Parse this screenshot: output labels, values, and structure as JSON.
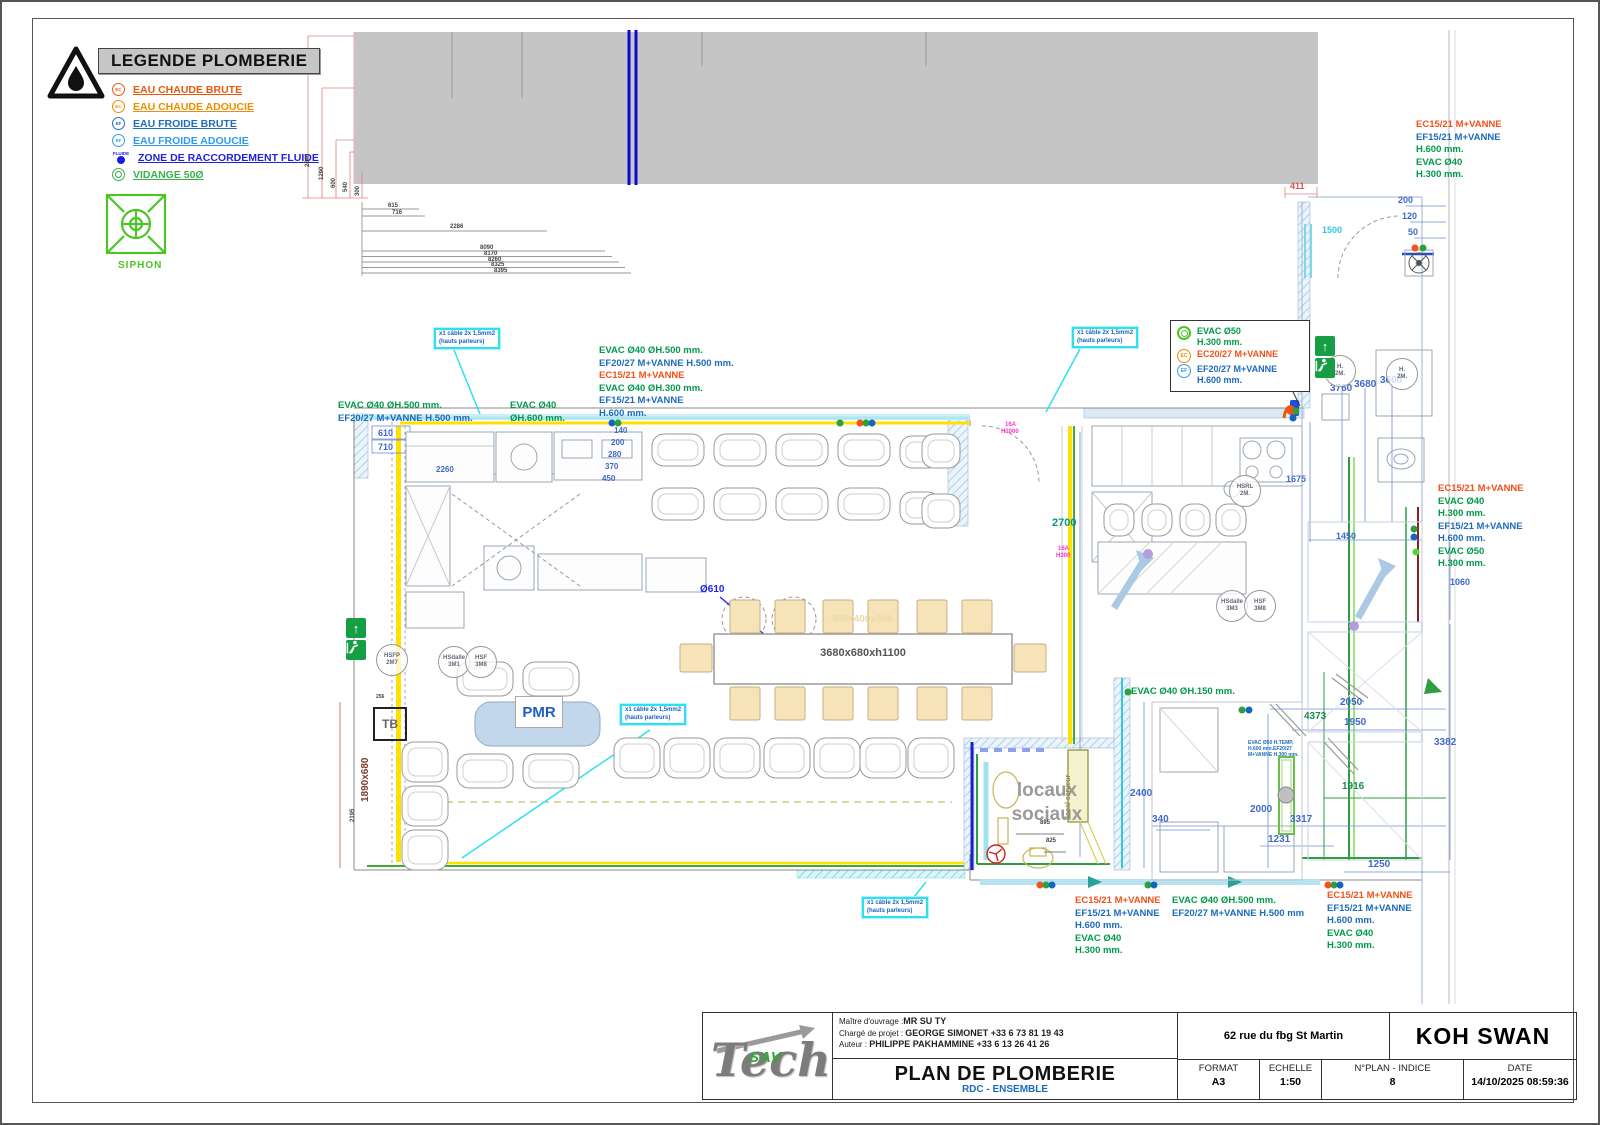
{
  "colors": {
    "hot_water": "#e8590c",
    "hot_softened": "#f08c00",
    "cold_water": "#1b6ec2",
    "cold_softened": "#2f9bf0",
    "fluid": "#2222dd",
    "drain": "#37b24d",
    "dim_blue": "#4169c9",
    "callout_cyan": "#2de0f0",
    "pink": "#ff2fd2",
    "wall_yellow": "#ffe000"
  },
  "legend": {
    "title": "LEGENDE PLOMBERIE",
    "items": [
      {
        "label": "EAU CHAUDE BRUTE",
        "color": "#e8590c",
        "icon": "ec",
        "icon_text": "EC"
      },
      {
        "label": "EAU CHAUDE ADOUCIE",
        "color": "#f08c00",
        "icon": "ec",
        "icon_text": "EC"
      },
      {
        "label": "EAU FROIDE BRUTE",
        "color": "#1b6ec2",
        "icon": "ef",
        "icon_text": "EF"
      },
      {
        "label": "EAU FROIDE ADOUCIE",
        "color": "#2f9bf0",
        "icon": "ef",
        "icon_text": "EF"
      },
      {
        "label": "ZONE DE RACCORDEMENT FLUIDE",
        "color": "#2222dd",
        "icon": "fluide",
        "icon_text": "FLUIDE"
      },
      {
        "label": "VIDANGE 50Ø",
        "color": "#37b24d",
        "icon": "vidange",
        "icon_text": ""
      }
    ],
    "siphon_label": "SIPHON"
  },
  "plan": {
    "cable_note_line1": "x1 câble 2x 1,5mm2",
    "cable_note_line2": "(hauts parleurs)",
    "cable_notes": [
      {
        "x": 432,
        "y": 326
      },
      {
        "x": 1070,
        "y": 325
      },
      {
        "x": 618,
        "y": 702
      },
      {
        "x": 860,
        "y": 895
      }
    ],
    "annotations": [
      {
        "x": 336,
        "y": 398,
        "lines": [
          {
            "t": "EVAC Ø40  ØH.500 mm.",
            "c": "g"
          },
          {
            "t": "EF20/27 M+VANNE H.500 mm.",
            "c": "b"
          }
        ]
      },
      {
        "x": 508,
        "y": 398,
        "lines": [
          {
            "t": "EVAC Ø40",
            "c": "g"
          },
          {
            "t": "ØH.600 mm.",
            "c": "g"
          }
        ]
      },
      {
        "x": 597,
        "y": 343,
        "lines": [
          {
            "t": "EVAC Ø40  ØH.500 mm.",
            "c": "g"
          },
          {
            "t": "EF20/27 M+VANNE H.500 mm.",
            "c": "b"
          },
          {
            "t": "EC15/21 M+VANNE",
            "c": "o"
          },
          {
            "t": "EVAC Ø40  ØH.300 mm.",
            "c": "g"
          },
          {
            "t": "EF15/21 M+VANNE",
            "c": "b"
          },
          {
            "t": "H.600 mm.",
            "c": "b"
          }
        ]
      },
      {
        "x": 1414,
        "y": 117,
        "lines": [
          {
            "t": "EC15/21 M+VANNE",
            "c": "o"
          },
          {
            "t": "EF15/21 M+VANNE",
            "c": "b"
          },
          {
            "t": "H.600 mm.",
            "c": "g"
          },
          {
            "t": "EVAC Ø40",
            "c": "g"
          },
          {
            "t": "H.300 mm.",
            "c": "g"
          }
        ]
      },
      {
        "x": 1436,
        "y": 481,
        "lines": [
          {
            "t": "EC15/21 M+VANNE",
            "c": "o"
          },
          {
            "t": "EVAC Ø40",
            "c": "g"
          },
          {
            "t": "H.300 mm.",
            "c": "g"
          },
          {
            "t": "EF15/21 M+VANNE",
            "c": "b"
          },
          {
            "t": "H.600 mm.",
            "c": "b"
          },
          {
            "t": "EVAC Ø50",
            "c": "g"
          },
          {
            "t": "H.300 mm.",
            "c": "g"
          }
        ]
      },
      {
        "x": 1129,
        "y": 684,
        "lines": [
          {
            "t": "EVAC Ø40  ØH.150 mm.",
            "c": "g"
          }
        ]
      },
      {
        "x": 1073,
        "y": 893,
        "lines": [
          {
            "t": "EC15/21 M+VANNE",
            "c": "o"
          },
          {
            "t": "EF15/21 M+VANNE",
            "c": "b"
          },
          {
            "t": "H.600 mm.",
            "c": "b"
          },
          {
            "t": "EVAC Ø40",
            "c": "g"
          },
          {
            "t": "H.300 mm.",
            "c": "g"
          }
        ]
      },
      {
        "x": 1170,
        "y": 893,
        "lines": [
          {
            "t": "EVAC Ø40  ØH.500 mm.",
            "c": "g"
          },
          {
            "t": "EF20/27 M+VANNE H.500 mm",
            "c": "b"
          }
        ]
      },
      {
        "x": 1325,
        "y": 888,
        "lines": [
          {
            "t": "EC15/21 M+VANNE",
            "c": "o"
          },
          {
            "t": "EF15/21 M+VANNE",
            "c": "b"
          },
          {
            "t": "H.600 mm.",
            "c": "b"
          },
          {
            "t": "EVAC Ø40",
            "c": "g"
          },
          {
            "t": "H.300 mm.",
            "c": "g"
          }
        ]
      },
      {
        "x": 1246,
        "y": 738,
        "sz": "tiny",
        "lines": [
          {
            "t": "EVAC Ø50 H.TEMP,",
            "c": "b"
          },
          {
            "t": "H.600 mm.EF20/27",
            "c": "b"
          },
          {
            "t": "M+VANNE H.300 mm.",
            "c": "b"
          }
        ]
      }
    ],
    "boxed_callout": {
      "rows": [
        {
          "icon": "vid",
          "lines": [
            {
              "t": "EVAC Ø50",
              "c": "g"
            },
            {
              "t": "H.300 mm.",
              "c": "g"
            }
          ]
        },
        {
          "icon": "ec",
          "lines": [
            {
              "t": "EC20/27 M+VANNE",
              "c": "o"
            }
          ]
        },
        {
          "icon": "ef",
          "lines": [
            {
              "t": "EF20/27 M+VANNE",
              "c": "b"
            },
            {
              "t": "H.600 mm.",
              "c": "b"
            }
          ]
        }
      ]
    },
    "dims": [
      {
        "t": "615",
        "x": 386,
        "y": 201,
        "c": "k",
        "s": 6
      },
      {
        "t": "716",
        "x": 390,
        "y": 208,
        "c": "k",
        "s": 6
      },
      {
        "t": "2286",
        "x": 448,
        "y": 222,
        "c": "k",
        "s": 6
      },
      {
        "t": "8090",
        "x": 478,
        "y": 243,
        "c": "k",
        "s": 6
      },
      {
        "t": "8170",
        "x": 482,
        "y": 249,
        "c": "k",
        "s": 6
      },
      {
        "t": "8260",
        "x": 486,
        "y": 255,
        "c": "k",
        "s": 6
      },
      {
        "t": "8325",
        "x": 489,
        "y": 260,
        "c": "k",
        "s": 6
      },
      {
        "t": "8395",
        "x": 492,
        "y": 266,
        "c": "k",
        "s": 6
      },
      {
        "t": "2040",
        "x": 303,
        "y": 165,
        "c": "k",
        "s": 6,
        "r": -90
      },
      {
        "t": "1290",
        "x": 317,
        "y": 178,
        "c": "k",
        "s": 6,
        "r": -90
      },
      {
        "t": "600",
        "x": 329,
        "y": 186,
        "c": "k",
        "s": 6,
        "r": -90
      },
      {
        "t": "540",
        "x": 341,
        "y": 190,
        "c": "k",
        "s": 6,
        "r": -90
      },
      {
        "t": "300",
        "x": 353,
        "y": 194,
        "c": "k",
        "s": 6,
        "r": -90
      },
      {
        "t": "411",
        "x": 1288,
        "y": 179,
        "c": "r",
        "s": 9
      },
      {
        "t": "1500",
        "x": 1320,
        "y": 223,
        "c": "cy",
        "s": 9
      },
      {
        "t": "200",
        "x": 1396,
        "y": 193,
        "c": "d",
        "s": 9
      },
      {
        "t": "120",
        "x": 1400,
        "y": 209,
        "c": "d",
        "s": 9
      },
      {
        "t": "50",
        "x": 1406,
        "y": 225,
        "c": "d",
        "s": 9
      },
      {
        "t": "610",
        "x": 376,
        "y": 426,
        "c": "d",
        "s": 9
      },
      {
        "t": "710",
        "x": 376,
        "y": 440,
        "c": "d",
        "s": 9
      },
      {
        "t": "2260",
        "x": 434,
        "y": 463,
        "c": "d",
        "s": 8
      },
      {
        "t": "140",
        "x": 612,
        "y": 424,
        "c": "d",
        "s": 8
      },
      {
        "t": "200",
        "x": 609,
        "y": 436,
        "c": "d",
        "s": 8
      },
      {
        "t": "280",
        "x": 606,
        "y": 448,
        "c": "d",
        "s": 8
      },
      {
        "t": "370",
        "x": 603,
        "y": 460,
        "c": "d",
        "s": 8
      },
      {
        "t": "450",
        "x": 600,
        "y": 472,
        "c": "d",
        "s": 8
      },
      {
        "t": "1675",
        "x": 1284,
        "y": 472,
        "c": "d",
        "s": 9
      },
      {
        "t": "2700",
        "x": 1050,
        "y": 515,
        "c": "t",
        "s": 11
      },
      {
        "t": "3760",
        "x": 1328,
        "y": 381,
        "c": "d",
        "s": 10
      },
      {
        "t": "3680",
        "x": 1352,
        "y": 377,
        "c": "d",
        "s": 10
      },
      {
        "t": "3600",
        "x": 1378,
        "y": 373,
        "c": "d",
        "s": 10
      },
      {
        "t": "1450",
        "x": 1334,
        "y": 529,
        "c": "d",
        "s": 9
      },
      {
        "t": "1060",
        "x": 1448,
        "y": 575,
        "c": "d",
        "s": 9
      },
      {
        "t": "2050",
        "x": 1338,
        "y": 695,
        "c": "d",
        "s": 10
      },
      {
        "t": "4373",
        "x": 1302,
        "y": 709,
        "c": "gn",
        "s": 10
      },
      {
        "t": "1950",
        "x": 1342,
        "y": 715,
        "c": "d",
        "s": 10
      },
      {
        "t": "1916",
        "x": 1340,
        "y": 779,
        "c": "gn",
        "s": 10
      },
      {
        "t": "2000",
        "x": 1248,
        "y": 802,
        "c": "d",
        "s": 10
      },
      {
        "t": "3317",
        "x": 1288,
        "y": 812,
        "c": "d",
        "s": 10
      },
      {
        "t": "1231",
        "x": 1266,
        "y": 832,
        "c": "d",
        "s": 10
      },
      {
        "t": "3382",
        "x": 1432,
        "y": 735,
        "c": "d",
        "s": 10
      },
      {
        "t": "2400",
        "x": 1128,
        "y": 786,
        "c": "d",
        "s": 10
      },
      {
        "t": "340",
        "x": 1150,
        "y": 812,
        "c": "d",
        "s": 10
      },
      {
        "t": "1250",
        "x": 1366,
        "y": 857,
        "c": "d",
        "s": 10
      },
      {
        "t": "256",
        "x": 374,
        "y": 692,
        "c": "k",
        "s": 5
      },
      {
        "t": "2195",
        "x": 348,
        "y": 820,
        "c": "k",
        "s": 6,
        "r": -90
      },
      {
        "t": "895",
        "x": 1038,
        "y": 818,
        "c": "k",
        "s": 6
      },
      {
        "t": "825",
        "x": 1044,
        "y": 836,
        "c": "k",
        "s": 6
      },
      {
        "t": "1890x680",
        "x": 358,
        "y": 800,
        "c": "dr",
        "s": 10,
        "r": -90
      },
      {
        "t": "Ø610",
        "x": 698,
        "y": 582,
        "c": "bl",
        "s": 10
      },
      {
        "t": "16A",
        "x": 1003,
        "y": 420,
        "c": "p",
        "s": 6
      },
      {
        "t": "H1000",
        "x": 999,
        "y": 427,
        "c": "p",
        "s": 6
      },
      {
        "t": "16A",
        "x": 1056,
        "y": 544,
        "c": "p",
        "s": 6
      },
      {
        "t": "H300",
        "x": 1054,
        "y": 551,
        "c": "p",
        "s": 6
      }
    ],
    "hs_circles": [
      {
        "x": 390,
        "y": 658,
        "l1": "HSFP",
        "l2": "2M7"
      },
      {
        "x": 452,
        "y": 660,
        "l1": "HSdalle",
        "l2": "3M1"
      },
      {
        "x": 479,
        "y": 660,
        "l1": "HSF",
        "l2": "3M8"
      },
      {
        "x": 1230,
        "y": 604,
        "l1": "HSdalle",
        "l2": "3M3"
      },
      {
        "x": 1258,
        "y": 604,
        "l1": "HSF",
        "l2": "3M8"
      },
      {
        "x": 1243,
        "y": 489,
        "l1": "HSRL",
        "l2": "2M."
      },
      {
        "x": 1338,
        "y": 369,
        "l1": "H.",
        "l2": "2M."
      },
      {
        "x": 1400,
        "y": 372,
        "l1": "H.",
        "l2": "2M."
      }
    ],
    "dots": [
      {
        "x": 610,
        "y": 421,
        "c": "#1565c0"
      },
      {
        "x": 616,
        "y": 421,
        "c": "#2f9e41"
      },
      {
        "x": 838,
        "y": 421,
        "c": "#2f9e41"
      },
      {
        "x": 858,
        "y": 421,
        "c": "#f4511e"
      },
      {
        "x": 864,
        "y": 421,
        "c": "#2f9e41"
      },
      {
        "x": 870,
        "y": 421,
        "c": "#1565c0"
      },
      {
        "x": 1288,
        "y": 409,
        "c": "#f4511e"
      },
      {
        "x": 1294,
        "y": 409,
        "c": "#2f9e41"
      },
      {
        "x": 1291,
        "y": 416,
        "c": "#1565c0"
      },
      {
        "x": 1413,
        "y": 246,
        "c": "#f4511e"
      },
      {
        "x": 1421,
        "y": 246,
        "c": "#2f9e41"
      },
      {
        "x": 1412,
        "y": 527,
        "c": "#2f9e41"
      },
      {
        "x": 1412,
        "y": 535,
        "c": "#1565c0"
      },
      {
        "x": 1414,
        "y": 550,
        "c": "#52d73d"
      },
      {
        "x": 1126,
        "y": 690,
        "c": "#2f9e41"
      },
      {
        "x": 1240,
        "y": 708,
        "c": "#2f9e41"
      },
      {
        "x": 1247,
        "y": 708,
        "c": "#1565c0"
      },
      {
        "x": 1038,
        "y": 883,
        "c": "#f4511e"
      },
      {
        "x": 1044,
        "y": 883,
        "c": "#2f9e41"
      },
      {
        "x": 1050,
        "y": 883,
        "c": "#1565c0"
      },
      {
        "x": 1146,
        "y": 883,
        "c": "#2f9e41"
      },
      {
        "x": 1152,
        "y": 883,
        "c": "#1565c0"
      },
      {
        "x": 1326,
        "y": 883,
        "c": "#f4511e"
      },
      {
        "x": 1332,
        "y": 883,
        "c": "#2f9e41"
      },
      {
        "x": 1338,
        "y": 883,
        "c": "#1565c0"
      },
      {
        "x": 1146,
        "y": 552,
        "c": "#b39ddb"
      },
      {
        "x": 1352,
        "y": 624,
        "c": "#b39ddb"
      }
    ],
    "pmr_label": "PMR",
    "table_label": "3680x680xh1100",
    "stool_label": "400x400x800",
    "tb_label": "TB",
    "locaux_line1": "locaux",
    "locaux_line2": "sociaux",
    "local_serveur": "local serveur"
  },
  "titleblock": {
    "owner_label": "Maître d'ouvrage :",
    "owner": "MR SU TY",
    "manager_label": "Chargé de projet :",
    "manager": "GEORGE SIMONET +33 6 73 81 19 43",
    "author_label": "Auteur :",
    "author": "PHILIPPE PAKHAMMINE +33 6 13 26 41 26",
    "title": "PLAN DE PLOMBERIE",
    "subtitle": "RDC - ENSEMBLE",
    "address": "62 rue du fbg St Martin",
    "project": "KOH SWAN",
    "format_label": "FORMAT",
    "format": "A3",
    "scale_label": "ECHELLE",
    "scale": "1:50",
    "plan_label": "N°PLAN - INDICE",
    "plan_index": "8",
    "date_label": "DATE",
    "date": "14/10/2025 08:59:36",
    "logo_text": "Tech",
    "logo_sub": "SAV"
  }
}
